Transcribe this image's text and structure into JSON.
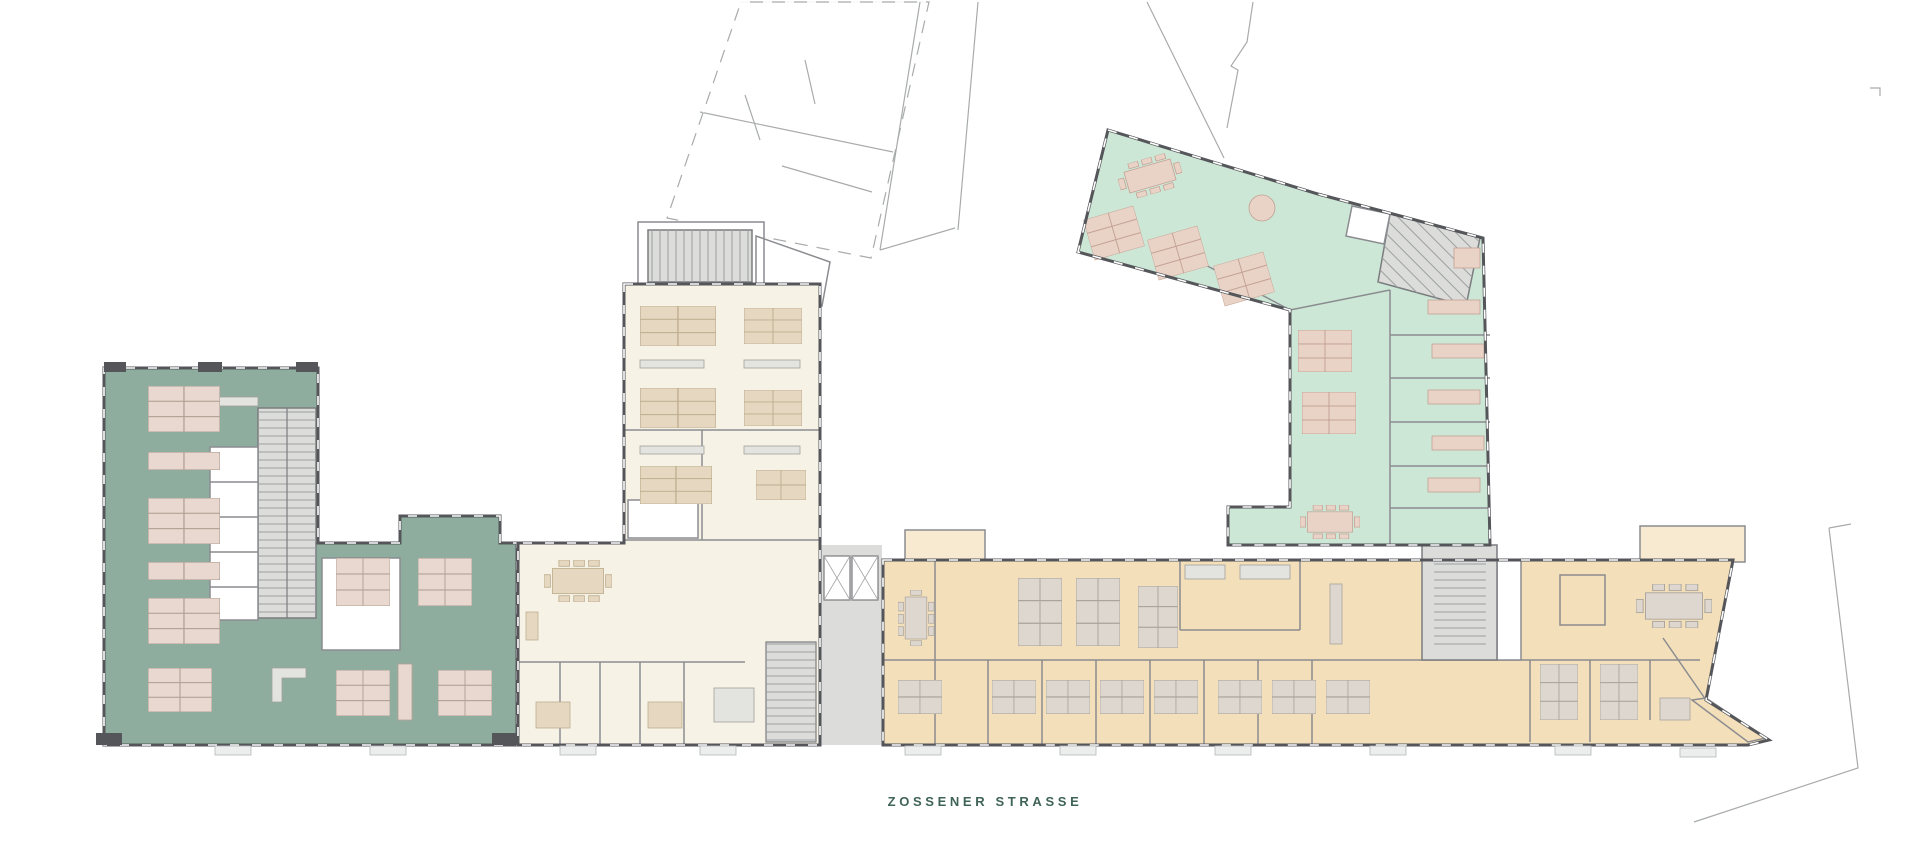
{
  "street_label": {
    "text": "ZOSSENER STRASSE"
  },
  "colors": {
    "background": "#ffffff",
    "wall_dark": "#55565a",
    "wall_mid": "#8b8c90",
    "outline_light": "#a8aca9",
    "teal_fill": "#8fad9f",
    "teal_desk": "#e8d8cf",
    "cream_fill": "#f6f2e6",
    "cream_desk": "#e5d7c0",
    "beige_fill": "#f3dfba",
    "bay_beige": "#f8ead0",
    "beige_desk": "#ddd7cf",
    "mint_fill": "#cde7d7",
    "mint_desk": "#e9d2c6",
    "core_gray": "#dcdcda",
    "label_text": "#3f6457"
  },
  "buildings": [
    {
      "id": "west-wing",
      "fill": "teal_fill"
    },
    {
      "id": "center-wing",
      "fill": "cream_fill"
    },
    {
      "id": "south-block",
      "fill": "beige_fill"
    },
    {
      "id": "northeast-wing",
      "fill": "mint_fill"
    }
  ]
}
